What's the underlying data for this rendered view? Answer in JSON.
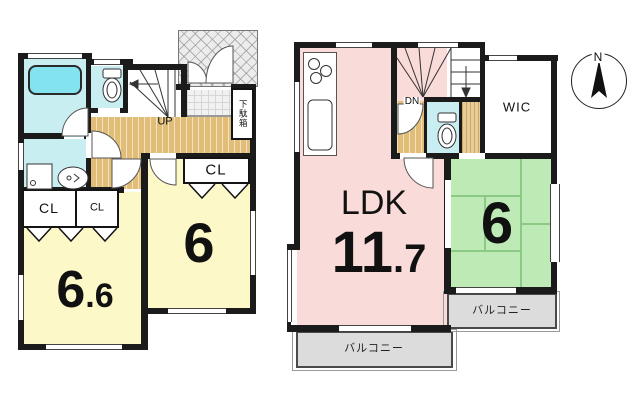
{
  "floor1": {
    "up_label": "UP",
    "shoe_cabinet_label": "下駄箱",
    "hall_closet_label": "CL",
    "closet_left_label": "CL",
    "closet_right_label": "CL",
    "bedroom_east_size": "6",
    "bedroom_west_int": "6",
    "bedroom_west_dec": ".6"
  },
  "floor2": {
    "down_label": "DN",
    "wic_label": "WIC",
    "ldk_label": "LDK",
    "ldk_int": "11",
    "ldk_dec": ".7",
    "tatami_size": "6",
    "balcony_ldk_label": "バルコニー",
    "balcony_tatami_label": "バルコニー"
  },
  "compass": {
    "north_label": "N"
  },
  "colors": {
    "wall": "#1b1b1b",
    "room_yellow": "#fcf8c8",
    "ldk_pink": "#f9dbd9",
    "tatami_green": "#bdeab5",
    "water_cyan": "#c9eef2",
    "bathtub_cyan": "#83e3ee",
    "flooring_tan": "#e2bd77",
    "balcony_gray": "#dcdcdc"
  }
}
